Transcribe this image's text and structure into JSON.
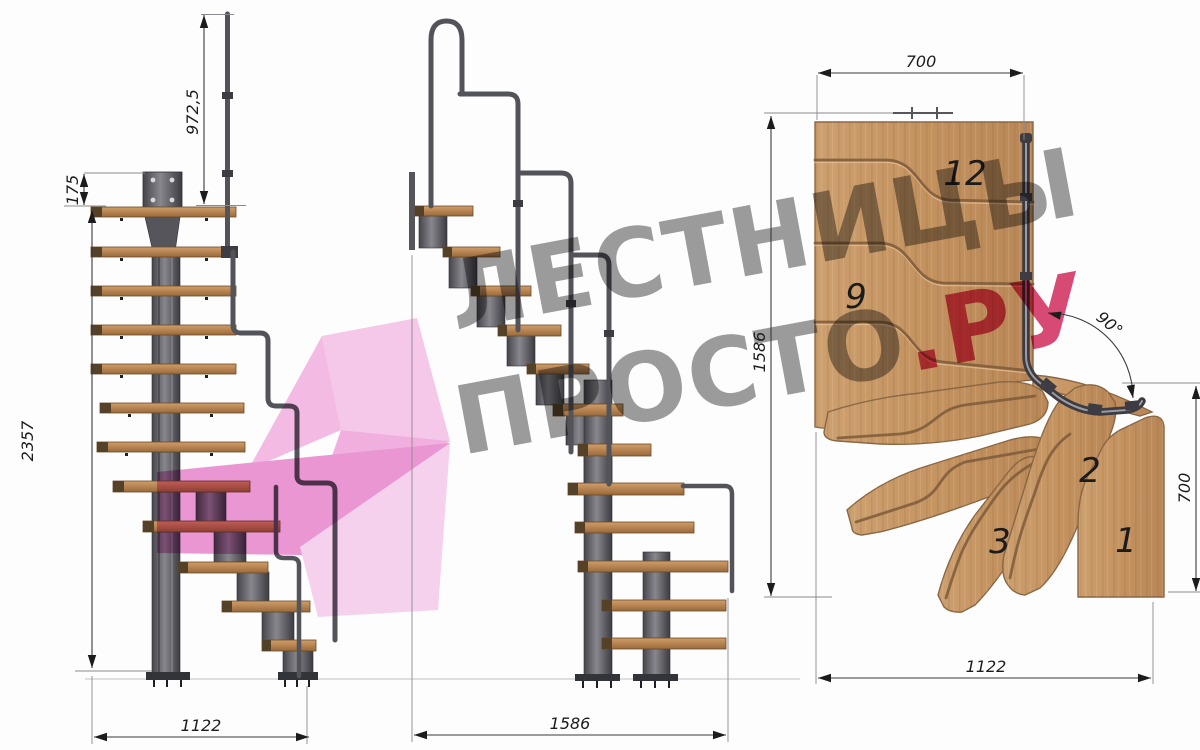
{
  "title": "Modular staircase technical drawing (three views)",
  "watermark": {
    "line1": "ЛЕСТНИЦЫ",
    "line2": "ПРОСТО",
    "suffix": ".РУ",
    "gray_color": "#9c9c9c",
    "pink_color": "#d84a73",
    "arrow_pink": "#f3b1e0"
  },
  "views": {
    "side": {
      "name": "side elevation",
      "dims": {
        "rail_height": "972,5",
        "plate_offset": "175",
        "total_height": "2357",
        "total_width": "1122"
      }
    },
    "front": {
      "name": "front elevation",
      "dims": {
        "total_width": "1586"
      }
    },
    "plan": {
      "name": "top view",
      "dims": {
        "top_width": "700",
        "left_depth": "1586",
        "right_depth": "700",
        "bottom_width": "1122",
        "turn_angle": "90°"
      },
      "step_numbers": {
        "n12": "12",
        "n9": "9",
        "n3": "3",
        "n2": "2",
        "n1": "1"
      }
    }
  },
  "colors": {
    "wood": "#c89a6c",
    "tread_front": "#b5834f",
    "metal": "#5c5c62",
    "rail": "#53535a",
    "dimension_lines": "#3a3a3a",
    "background": "#fdfdfe"
  }
}
